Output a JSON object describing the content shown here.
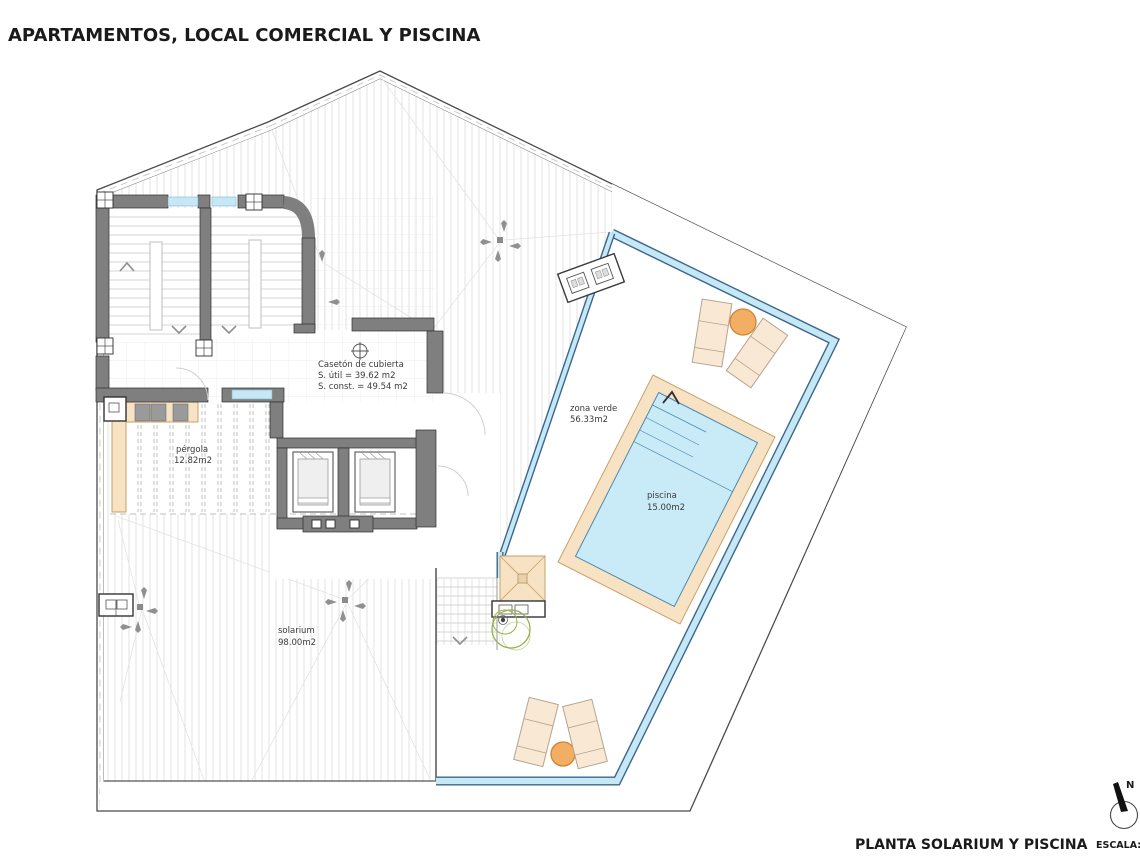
{
  "title": "APARTAMENTOS, LOCAL COMERCIAL Y PISCINA",
  "footer": {
    "plan_title": "PLANTA SOLARIUM Y PISCINA",
    "scale_label": "ESCALA:"
  },
  "north": {
    "label": "N"
  },
  "rooms": {
    "caseton": {
      "name": "Casetón de cubierta",
      "sutil": "S. útil = 39.62 m2",
      "sconst": "S. const. = 49.54 m2"
    },
    "zona_verde": {
      "name": "zona verde",
      "area": "56.33m2"
    },
    "piscina": {
      "name": "piscina",
      "area": "15.00m2"
    },
    "pergola": {
      "name": "pérgola",
      "area": "12.82m2"
    },
    "solarium": {
      "name": "solarium",
      "area": "98.00m2"
    }
  },
  "colors": {
    "wall": "#7f7f7f",
    "water": "#c9ebf8",
    "glass": "#c6e7f4",
    "peach": "#f7e2c4",
    "peach_line": "#c9a06a",
    "lounger": "#f9e9d4",
    "table_orange": "#f2ae62",
    "balustrade": "#39678f",
    "arrow": "#909090",
    "plant_green": "#9ab04f"
  }
}
